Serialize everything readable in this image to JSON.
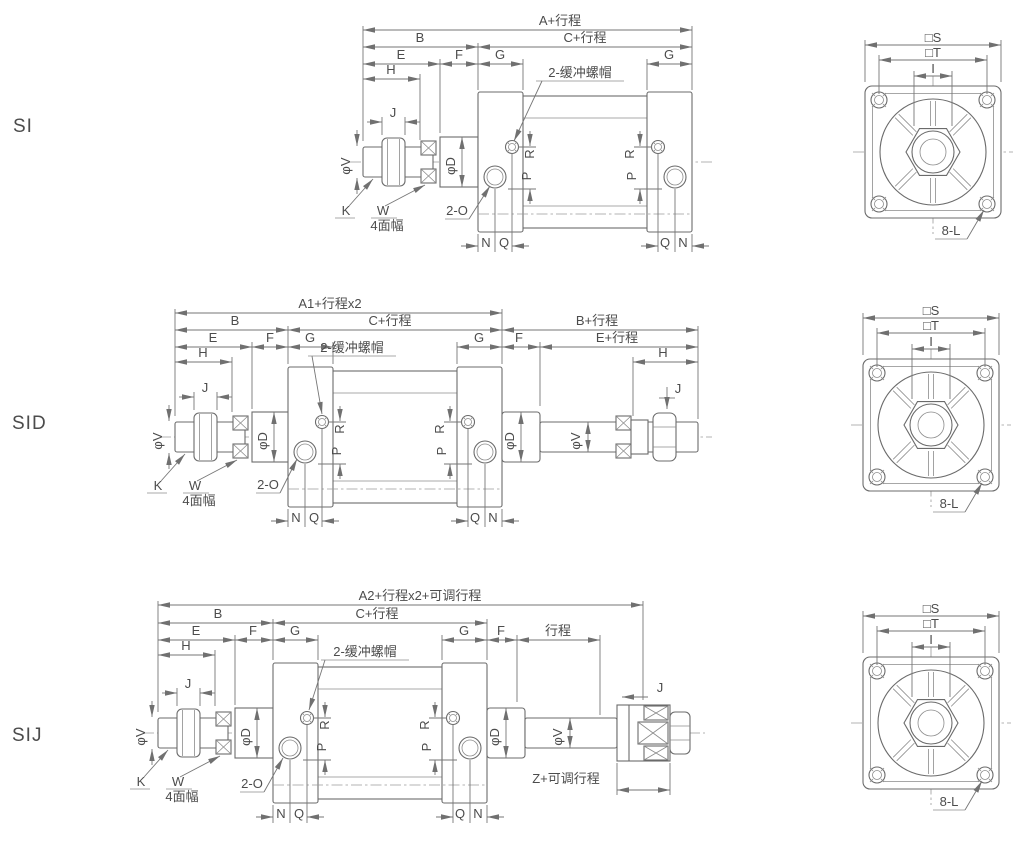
{
  "variants": {
    "row1": "SI",
    "row2": "SID",
    "row3": "SIJ"
  },
  "dims": {
    "a_stroke": "A+行程",
    "a1_stroke": "A1+行程x2",
    "a2_stroke": "A2+行程x2+可调行程",
    "b": "B",
    "b_stroke": "B+行程",
    "c_stroke": "C+行程",
    "e": "E",
    "e_stroke": "E+行程",
    "f": "F",
    "g": "G",
    "h": "H",
    "j": "J",
    "stroke": "行程",
    "z_adj": "Z+可调行程",
    "k": "K",
    "w": "W",
    "w_flats": "4面幅",
    "ports": "2-O",
    "cushion_cap": "2-缓冲螺帽",
    "n": "N",
    "q": "Q",
    "p": "P",
    "r": "R",
    "phi_v": "φV",
    "phi_d": "φD"
  },
  "end_view": {
    "s": "□S",
    "t": "□T",
    "i": "I",
    "bolt_note": "8-L"
  },
  "colors": {
    "line": "#6b6b6b",
    "text": "#4c4c4c",
    "background": "#ffffff"
  }
}
